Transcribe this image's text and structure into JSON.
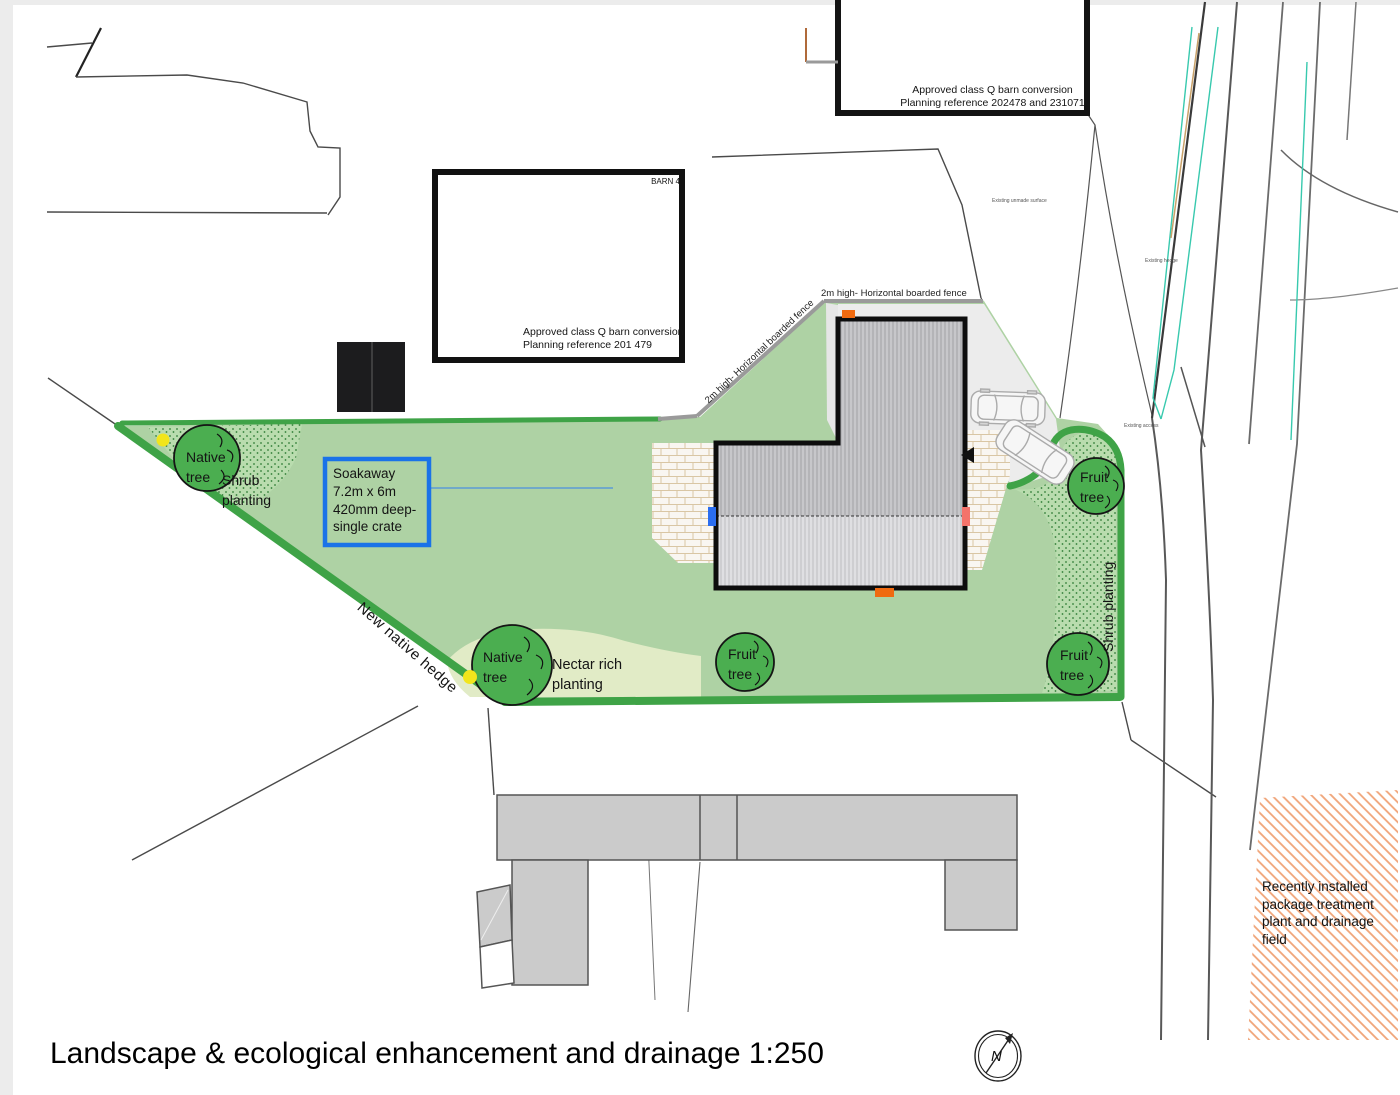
{
  "page": {
    "title": "Landscape & ecological enhancement and drainage 1:250",
    "north_label": "N"
  },
  "plan": {
    "labels": {
      "barn4": "BARN 4",
      "approval_main": "Approved class Q barn conversion\nPlanning reference 201 479",
      "approval_upper": "Approved class Q barn conversion\nPlanning reference 202478 and 231071",
      "fence_top": "2m high- Horizontal boarded fence",
      "fence_diag": "2m high- Horizontal boarded fence",
      "soakaway": "Soakaway\n7.2m x 6m\n420mm deep-\nsingle crate",
      "native_tree_nw": "Native\ntree",
      "native_tree_sw": "Native\ntree",
      "shrub_planting_nw": "Shrub\nplanting",
      "shrub_planting_east": "Shrub planting",
      "nectar": "Nectar rich\nplanting",
      "new_hedge": "New native hedge",
      "fruit_tree_mid": "Fruit\ntree",
      "fruit_tree_ne": "Fruit\ntree",
      "fruit_tree_se": "Fruit\ntree",
      "treatment": "Recently installed\npackage treatment\nplant and drainage\nfield",
      "existing_surface": "Existing unmade surface",
      "existing_hedge": "Existing hedge",
      "existing_access": "Existing access"
    },
    "colors": {
      "site_green": "#aed2a4",
      "hedge_green": "#3fa347",
      "tree_green": "#4bae50",
      "nectar_green": "#e1ebc6",
      "soakaway_blue": "#1a73e8",
      "leader_blue": "#5b9bd5",
      "marker_orange": "#f06a10",
      "marker_blue": "#2a6df0",
      "marker_red": "#f4736b",
      "dot_yellow": "#f2e51c",
      "treatment_hatch_orange": "#f0a478",
      "existing_hedge_teal": "#38c9ae",
      "verge_tan": "#c9a26a",
      "fence_gray": "#9a9a9a",
      "parking_gray": "#ececec",
      "building_gray": "#cbcbcb"
    }
  }
}
